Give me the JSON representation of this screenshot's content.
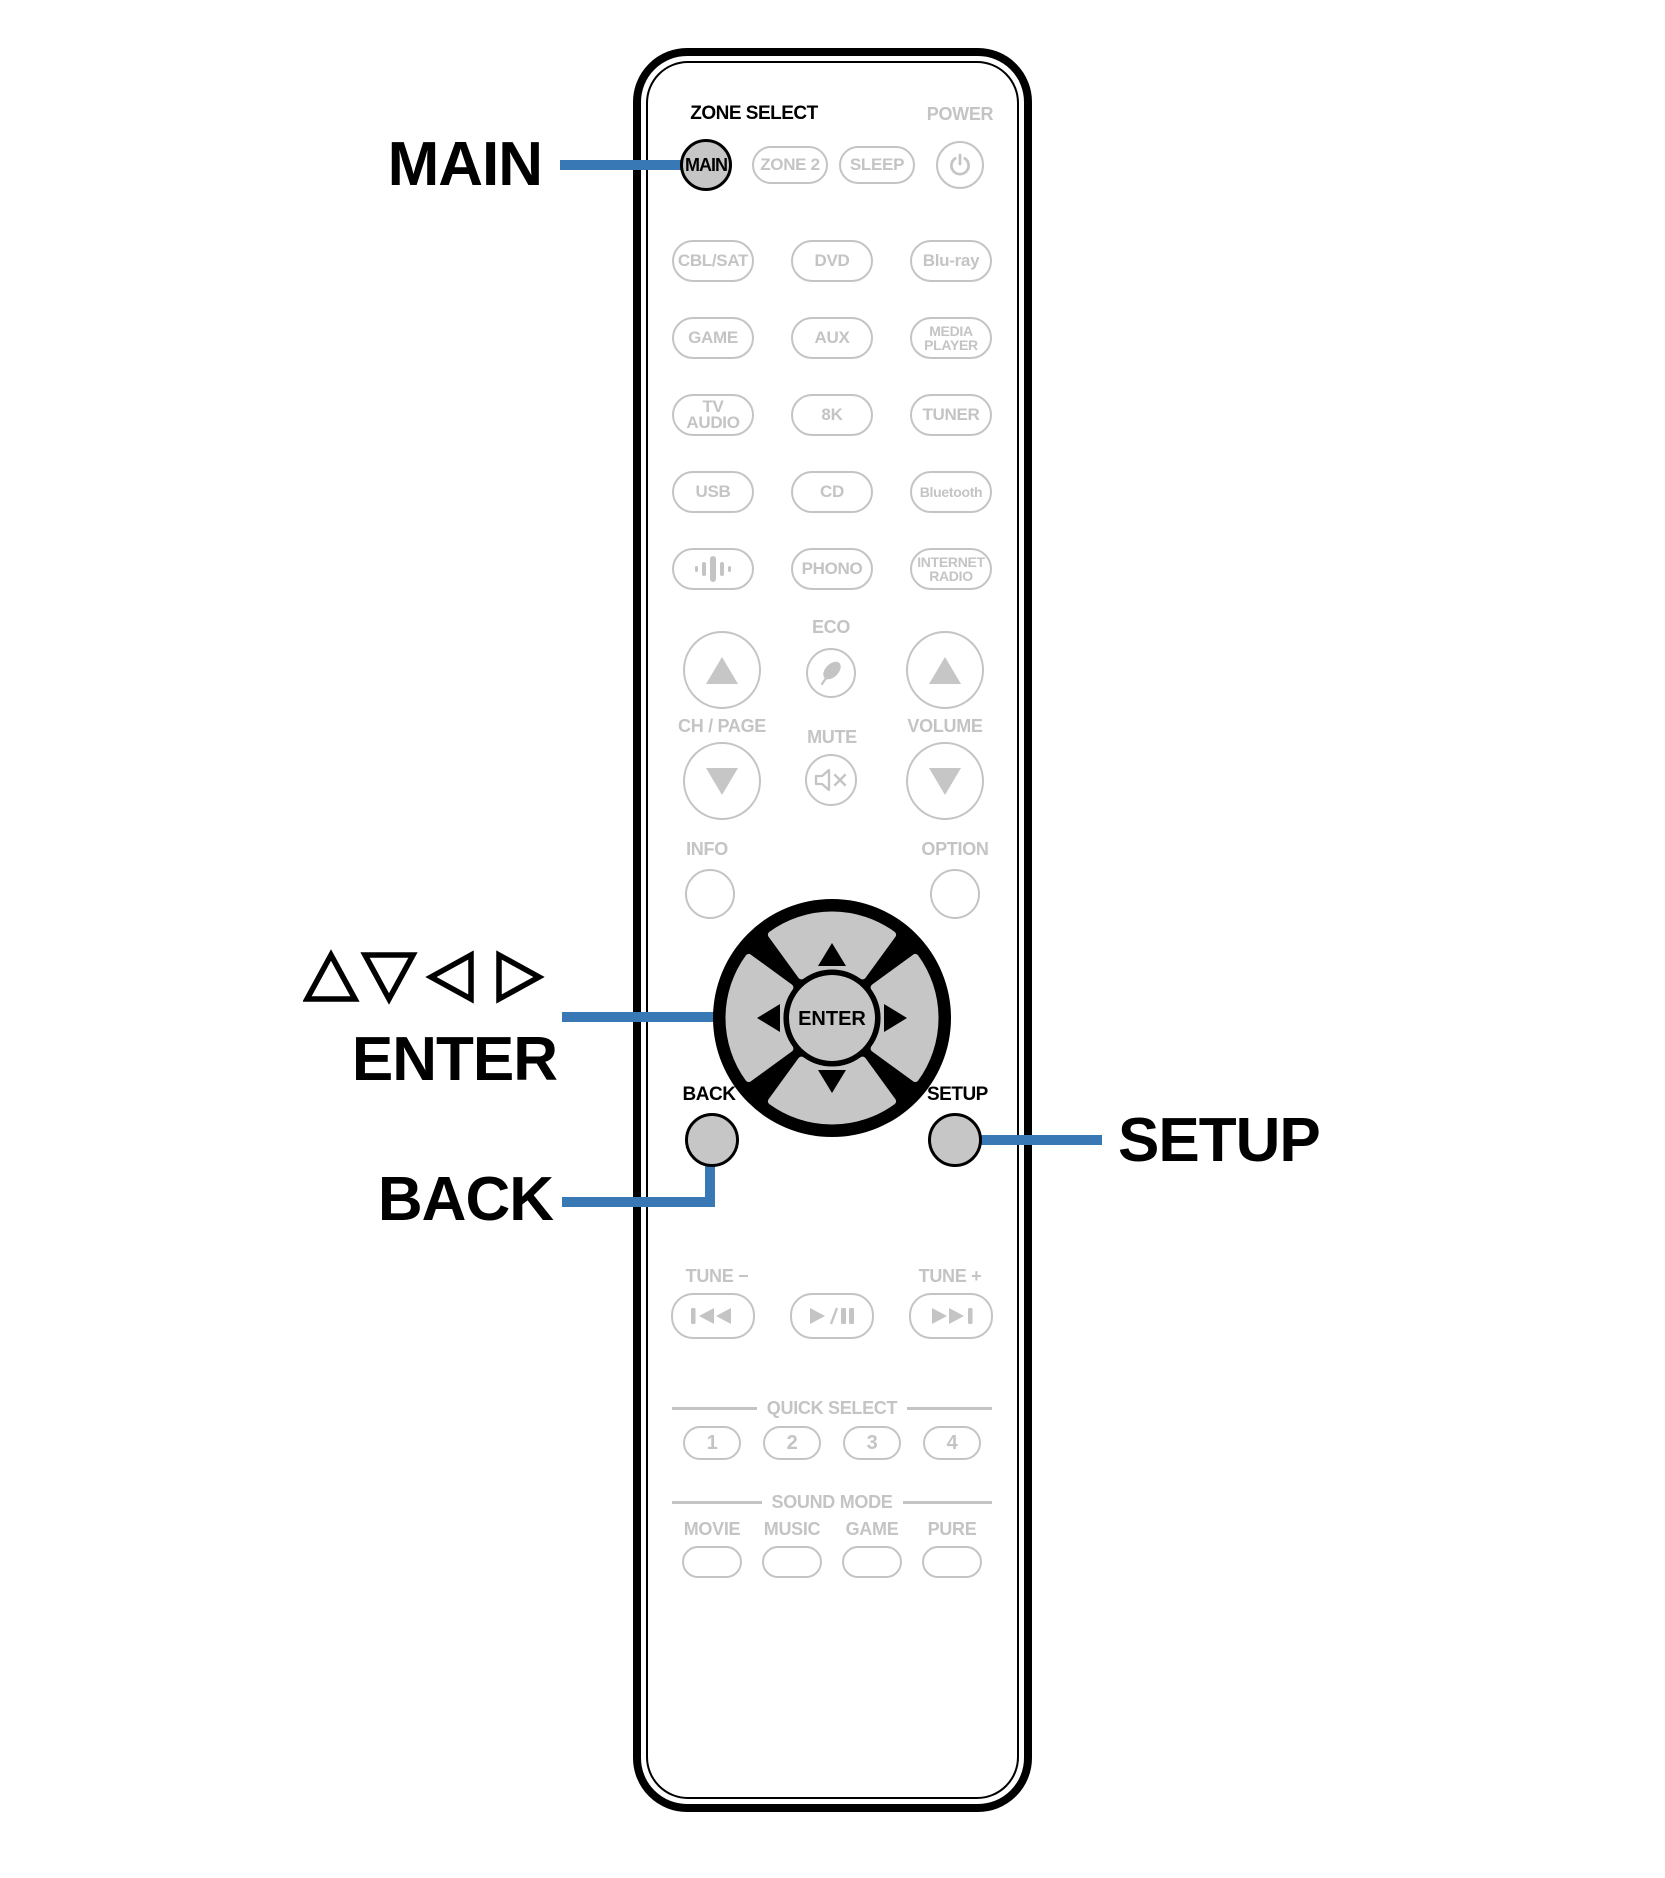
{
  "colors": {
    "accent_blue": "#3878b4",
    "inactive_gray": "#c4c4c4",
    "button_fill_gray": "#c6c6c6",
    "outline_black": "#000000"
  },
  "callouts": {
    "main": "MAIN",
    "cursor": "△▽◁ ▷",
    "enter": "ENTER",
    "back": "BACK",
    "setup": "SETUP"
  },
  "remote": {
    "zone_select_label": "ZONE SELECT",
    "power_label": "POWER",
    "main_button": "MAIN",
    "zone2_button": "ZONE 2",
    "sleep_button": "SLEEP",
    "sources": [
      {
        "label": "CBL/SAT"
      },
      {
        "label": "DVD"
      },
      {
        "label": "Blu-ray"
      },
      {
        "label": "GAME"
      },
      {
        "label": "AUX"
      },
      {
        "label": "MEDIA PLAYER"
      },
      {
        "label": "TV AUDIO"
      },
      {
        "label": "8K"
      },
      {
        "label": "TUNER"
      },
      {
        "label": "USB"
      },
      {
        "label": "CD"
      },
      {
        "label": "Bluetooth"
      },
      {
        "label": "",
        "icon": "heos-icon"
      },
      {
        "label": "PHONO"
      },
      {
        "label": "INTERNET RADIO"
      }
    ],
    "eco_label": "ECO",
    "ch_page_label": "CH / PAGE",
    "mute_label": "MUTE",
    "volume_label": "VOLUME",
    "info_label": "INFO",
    "option_label": "OPTION",
    "enter_button": "ENTER",
    "back_label": "BACK",
    "setup_label": "SETUP",
    "tune_minus_label": "TUNE −",
    "tune_plus_label": "TUNE +",
    "quick_select_label": "QUICK SELECT",
    "quick_select_buttons": [
      "1",
      "2",
      "3",
      "4"
    ],
    "sound_mode_label": "SOUND MODE",
    "sound_mode_buttons": [
      "MOVIE",
      "MUSIC",
      "GAME",
      "PURE"
    ]
  }
}
